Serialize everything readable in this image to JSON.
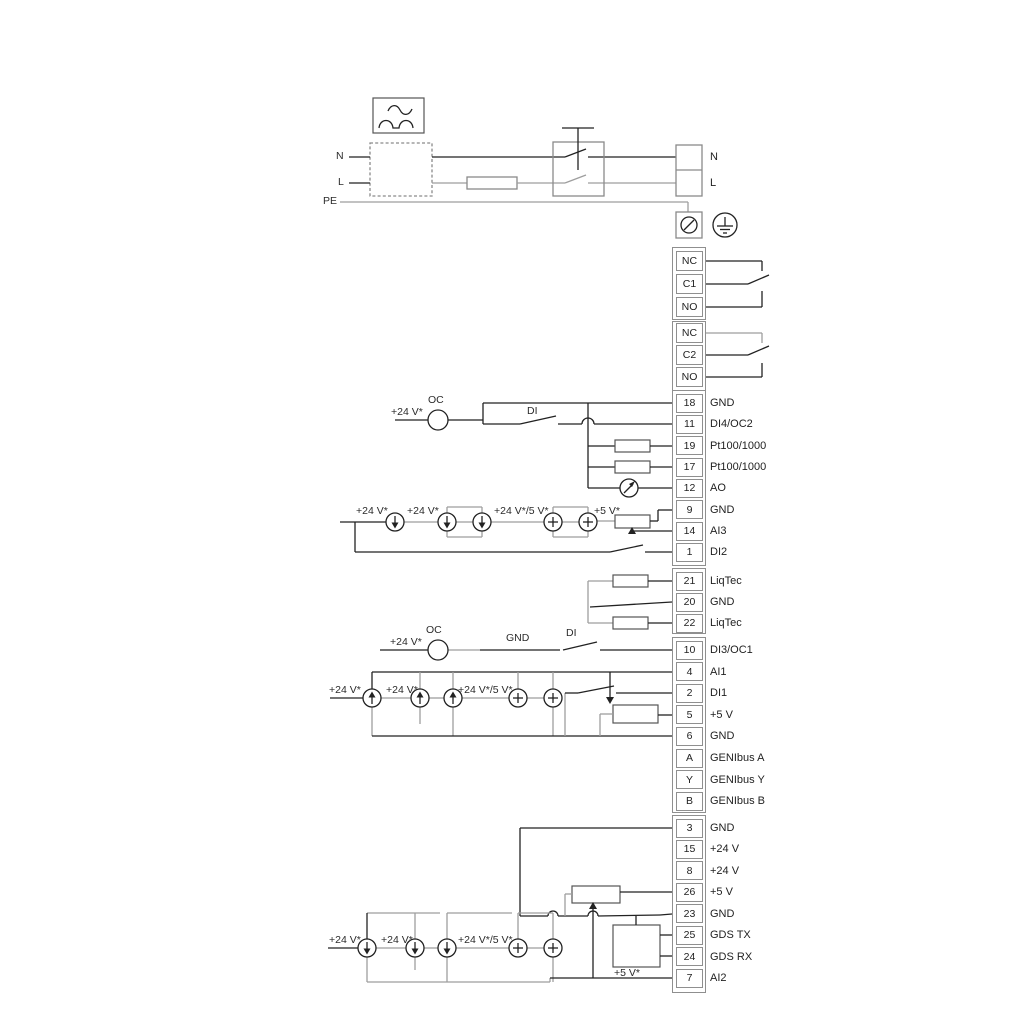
{
  "wire_labels": {
    "n": "N",
    "l": "L",
    "pe": "PE",
    "plus24": "+24 V*",
    "plus24_5": "+24 V*/5 V*",
    "plus5": "+5 V*",
    "oc": "OC",
    "di": "DI",
    "gnd": "GND"
  },
  "terminal_blocks": [
    {
      "id": "mains",
      "cells": [
        {
          "id": "",
          "label": "N"
        },
        {
          "id": "",
          "label": "L"
        }
      ]
    },
    {
      "id": "relay1",
      "cells": [
        {
          "id": "NC"
        },
        {
          "id": "C1"
        },
        {
          "id": "NO"
        }
      ]
    },
    {
      "id": "relay2",
      "cells": [
        {
          "id": "NC"
        },
        {
          "id": "C2"
        },
        {
          "id": "NO"
        }
      ]
    },
    {
      "id": "io1",
      "cells": [
        {
          "id": "18",
          "label": "GND"
        },
        {
          "id": "11",
          "label": "DI4/OC2"
        },
        {
          "id": "19",
          "label": "Pt100/1000"
        },
        {
          "id": "17",
          "label": "Pt100/1000"
        },
        {
          "id": "12",
          "label": "AO"
        },
        {
          "id": "9",
          "label": "GND"
        },
        {
          "id": "14",
          "label": "AI3"
        },
        {
          "id": "1",
          "label": "DI2"
        }
      ]
    },
    {
      "id": "liqtec",
      "cells": [
        {
          "id": "21",
          "label": "LiqTec"
        },
        {
          "id": "20",
          "label": "GND"
        },
        {
          "id": "22",
          "label": "LiqTec"
        }
      ]
    },
    {
      "id": "io2",
      "cells": [
        {
          "id": "10",
          "label": "DI3/OC1"
        },
        {
          "id": "4",
          "label": "AI1"
        },
        {
          "id": "2",
          "label": "DI1"
        },
        {
          "id": "5",
          "label": "+5 V"
        },
        {
          "id": "6",
          "label": "GND"
        },
        {
          "id": "A",
          "label": "GENIbus A"
        },
        {
          "id": "Y",
          "label": "GENIbus Y"
        },
        {
          "id": "B",
          "label": "GENIbus B"
        }
      ]
    },
    {
      "id": "io3",
      "cells": [
        {
          "id": "3",
          "label": "GND"
        },
        {
          "id": "15",
          "label": "+24 V"
        },
        {
          "id": "8",
          "label": "+24 V"
        },
        {
          "id": "26",
          "label": "+5 V"
        },
        {
          "id": "23",
          "label": "GND"
        },
        {
          "id": "25",
          "label": "GDS TX"
        },
        {
          "id": "24",
          "label": "GDS RX"
        },
        {
          "id": "7",
          "label": "AI2"
        }
      ]
    }
  ],
  "colors": {
    "background": "#ffffff",
    "wire_dark": "#222222",
    "wire_gray": "#9e9e9e",
    "box_border": "#8f8f8f",
    "text": "#2b2b2b"
  }
}
